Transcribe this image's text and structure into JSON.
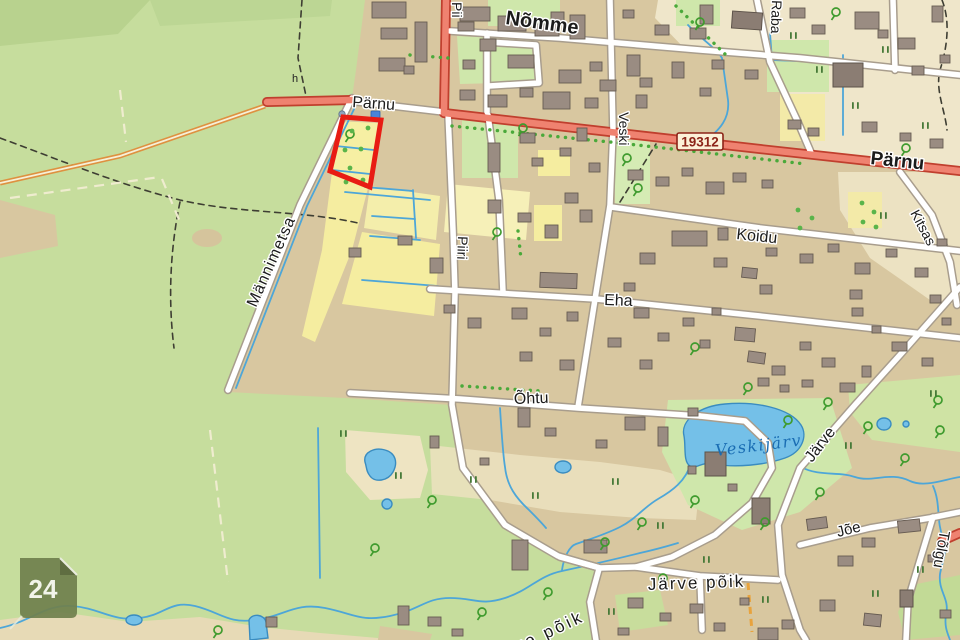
{
  "map": {
    "title": "Topographic map viewer",
    "badges": {
      "road_number": "19312",
      "sheet_number": "24"
    },
    "labels": {
      "nomme": "Nõmme",
      "parnu_west": "Pärnu",
      "parnu_east": "Pärnu",
      "piiri_top": "Pii",
      "piiri": "Piiri",
      "veski": "Veski",
      "raba": "Raba",
      "koidu": "Koidu",
      "eha": "Eha",
      "ohtu": "Õhtu",
      "mannimetsa": "Männimetsa",
      "jarve": "Järve",
      "kitsas": "Kitsas",
      "joe": "Jõe",
      "tolgu": "Tõlgu",
      "jarve_poik": "Järve põik",
      "jarve_poik_south": "Järve põik",
      "veskijarv": "Veskijärv",
      "symbol_h": "h"
    },
    "colors": {
      "forest": "#c6dd9d",
      "urban": "#d8c7a0",
      "field_yellow": "#f5eda0",
      "wetland_cream": "#efe6ca",
      "garden_green": "#cfe7ab",
      "water": "#74c0e8",
      "stream": "#4da6d8",
      "main_road": "#ef8270",
      "main_road_casing": "#c03f2e",
      "road_white": "#ffffff",
      "building": "#9a8c82",
      "parcel_highlight": "#e81c14",
      "sheet_badge": "#70804d",
      "tree_green": "#3f9b2e",
      "water_label": "#1a6db3",
      "road_number_text": "#8c2418"
    },
    "geometry": {
      "buildings": [
        [
          372,
          2,
          34,
          16
        ],
        [
          381,
          28,
          26,
          11
        ],
        [
          415,
          22,
          12,
          40
        ],
        [
          379,
          58,
          26,
          13
        ],
        [
          404,
          66,
          10,
          8
        ],
        [
          460,
          7,
          30,
          14
        ],
        [
          458,
          22,
          16,
          9
        ],
        [
          498,
          16,
          28,
          15
        ],
        [
          535,
          24,
          24,
          12
        ],
        [
          480,
          39,
          16,
          12
        ],
        [
          508,
          55,
          26,
          13
        ],
        [
          463,
          60,
          12,
          9
        ],
        [
          551,
          12,
          13,
          9
        ],
        [
          570,
          15,
          15,
          24
        ],
        [
          559,
          70,
          22,
          13
        ],
        [
          590,
          62,
          12,
          9
        ],
        [
          600,
          80,
          16,
          11
        ],
        [
          627,
          55,
          13,
          21
        ],
        [
          640,
          78,
          12,
          9
        ],
        [
          623,
          10,
          11,
          8
        ],
        [
          655,
          25,
          14,
          10
        ],
        [
          672,
          62,
          12,
          16
        ],
        [
          690,
          28,
          16,
          11
        ],
        [
          700,
          5,
          13,
          19
        ],
        [
          712,
          60,
          12,
          9
        ],
        [
          745,
          70,
          13,
          9
        ],
        [
          700,
          88,
          11,
          8
        ],
        [
          790,
          8,
          15,
          10
        ],
        [
          812,
          25,
          13,
          9
        ],
        [
          855,
          12,
          24,
          17
        ],
        [
          898,
          38,
          17,
          11
        ],
        [
          932,
          6,
          11,
          16
        ],
        [
          912,
          66,
          12,
          9
        ],
        [
          940,
          55,
          10,
          8
        ],
        [
          878,
          30,
          10,
          8
        ],
        [
          460,
          90,
          15,
          10
        ],
        [
          488,
          95,
          19,
          12
        ],
        [
          520,
          88,
          13,
          9
        ],
        [
          543,
          92,
          27,
          17
        ],
        [
          585,
          98,
          13,
          10
        ],
        [
          636,
          95,
          11,
          13
        ],
        [
          628,
          170,
          15,
          10
        ],
        [
          656,
          177,
          13,
          9
        ],
        [
          682,
          168,
          11,
          8
        ],
        [
          706,
          182,
          18,
          12
        ],
        [
          733,
          173,
          13,
          9
        ],
        [
          762,
          180,
          11,
          8
        ],
        [
          788,
          120,
          13,
          9
        ],
        [
          808,
          128,
          11,
          8
        ],
        [
          862,
          122,
          15,
          10
        ],
        [
          900,
          133,
          11,
          8
        ],
        [
          930,
          139,
          13,
          9
        ],
        [
          488,
          143,
          12,
          29
        ],
        [
          520,
          133,
          15,
          10
        ],
        [
          532,
          158,
          11,
          8
        ],
        [
          488,
          200,
          13,
          13
        ],
        [
          518,
          213,
          13,
          9
        ],
        [
          560,
          148,
          11,
          8
        ],
        [
          577,
          128,
          10,
          13
        ],
        [
          589,
          163,
          11,
          9
        ],
        [
          565,
          193,
          13,
          10
        ],
        [
          545,
          225,
          13,
          13
        ],
        [
          580,
          210,
          12,
          12
        ],
        [
          640,
          253,
          15,
          11
        ],
        [
          672,
          231,
          35,
          15
        ],
        [
          714,
          258,
          13,
          9
        ],
        [
          742,
          268,
          15,
          10,
          6
        ],
        [
          766,
          248,
          11,
          8
        ],
        [
          800,
          254,
          13,
          9
        ],
        [
          828,
          244,
          11,
          8
        ],
        [
          855,
          263,
          15,
          11
        ],
        [
          886,
          249,
          11,
          8
        ],
        [
          915,
          268,
          13,
          9
        ],
        [
          937,
          239,
          10,
          7
        ],
        [
          624,
          283,
          11,
          8
        ],
        [
          718,
          228,
          10,
          12
        ],
        [
          760,
          285,
          12,
          9
        ],
        [
          850,
          290,
          12,
          9
        ],
        [
          930,
          295,
          11,
          8
        ],
        [
          349,
          248,
          12,
          9
        ],
        [
          430,
          258,
          13,
          15
        ],
        [
          398,
          236,
          14,
          9
        ],
        [
          540,
          273,
          37,
          15,
          2
        ],
        [
          444,
          305,
          11,
          8
        ],
        [
          468,
          318,
          13,
          10
        ],
        [
          512,
          308,
          15,
          11
        ],
        [
          540,
          328,
          11,
          8
        ],
        [
          567,
          312,
          11,
          9
        ],
        [
          520,
          352,
          12,
          9
        ],
        [
          560,
          360,
          14,
          10
        ],
        [
          608,
          338,
          13,
          9
        ],
        [
          634,
          308,
          15,
          10
        ],
        [
          658,
          333,
          11,
          8
        ],
        [
          683,
          318,
          11,
          8
        ],
        [
          640,
          360,
          12,
          9
        ],
        [
          700,
          340,
          10,
          8
        ],
        [
          712,
          308,
          9,
          7
        ],
        [
          735,
          328,
          20,
          13,
          5
        ],
        [
          748,
          352,
          17,
          11,
          8
        ],
        [
          772,
          366,
          13,
          9
        ],
        [
          800,
          342,
          11,
          8
        ],
        [
          822,
          358,
          13,
          9
        ],
        [
          852,
          308,
          11,
          8
        ],
        [
          872,
          326,
          9,
          7
        ],
        [
          892,
          342,
          15,
          9
        ],
        [
          922,
          358,
          11,
          8
        ],
        [
          942,
          318,
          9,
          7
        ],
        [
          758,
          378,
          11,
          8
        ],
        [
          780,
          385,
          9,
          7
        ],
        [
          802,
          380,
          11,
          7
        ],
        [
          840,
          383,
          15,
          9
        ],
        [
          862,
          366,
          9,
          11
        ],
        [
          518,
          408,
          12,
          19
        ],
        [
          545,
          428,
          11,
          8
        ],
        [
          625,
          417,
          20,
          13
        ],
        [
          658,
          427,
          10,
          19
        ],
        [
          688,
          408,
          10,
          8
        ],
        [
          480,
          458,
          9,
          7
        ],
        [
          430,
          436,
          9,
          12
        ],
        [
          596,
          440,
          11,
          8
        ],
        [
          688,
          466,
          8,
          8
        ],
        [
          728,
          484,
          9,
          7
        ],
        [
          807,
          518,
          20,
          11,
          -8
        ],
        [
          898,
          520,
          22,
          12,
          -6
        ],
        [
          862,
          538,
          13,
          9
        ],
        [
          838,
          556,
          15,
          10
        ],
        [
          864,
          614,
          17,
          12,
          6
        ],
        [
          820,
          600,
          15,
          11
        ],
        [
          928,
          555,
          9,
          7
        ],
        [
          940,
          610,
          11,
          8
        ],
        [
          782,
          620,
          12,
          9
        ],
        [
          758,
          628,
          20,
          12
        ],
        [
          628,
          598,
          15,
          10
        ],
        [
          660,
          613,
          11,
          8
        ],
        [
          690,
          604,
          13,
          9
        ],
        [
          714,
          623,
          11,
          8
        ],
        [
          740,
          598,
          9,
          7
        ],
        [
          618,
          628,
          11,
          7
        ],
        [
          584,
          540,
          23,
          13
        ],
        [
          512,
          540,
          16,
          30
        ],
        [
          398,
          606,
          11,
          19
        ],
        [
          428,
          617,
          13,
          9
        ],
        [
          452,
          629,
          11,
          7
        ],
        [
          266,
          617,
          11,
          10
        ]
      ],
      "buildings_dark": [
        [
          732,
          12,
          30,
          17,
          4
        ],
        [
          833,
          63,
          30,
          24
        ],
        [
          705,
          452,
          21,
          24
        ],
        [
          752,
          498,
          18,
          26
        ],
        [
          900,
          590,
          13,
          17
        ]
      ],
      "trees": [
        [
          350,
          134
        ],
        [
          523,
          128
        ],
        [
          497,
          232
        ],
        [
          627,
          158
        ],
        [
          638,
          188
        ],
        [
          695,
          347
        ],
        [
          748,
          387
        ],
        [
          788,
          420
        ],
        [
          828,
          402
        ],
        [
          868,
          426
        ],
        [
          905,
          458
        ],
        [
          938,
          400
        ],
        [
          820,
          492
        ],
        [
          765,
          522
        ],
        [
          695,
          500
        ],
        [
          642,
          522
        ],
        [
          605,
          542
        ],
        [
          663,
          578
        ],
        [
          700,
          22
        ],
        [
          836,
          12
        ],
        [
          906,
          148
        ],
        [
          432,
          500
        ],
        [
          482,
          612
        ],
        [
          548,
          592
        ],
        [
          375,
          548
        ],
        [
          940,
          430
        ],
        [
          218,
          630
        ]
      ],
      "grass": [
        [
          470,
          476
        ],
        [
          532,
          492
        ],
        [
          612,
          478
        ],
        [
          657,
          522
        ],
        [
          703,
          556
        ],
        [
          762,
          596
        ],
        [
          872,
          590
        ],
        [
          917,
          566
        ],
        [
          845,
          442
        ],
        [
          395,
          472
        ],
        [
          790,
          32
        ],
        [
          816,
          66
        ],
        [
          852,
          102
        ],
        [
          882,
          46
        ],
        [
          922,
          122
        ],
        [
          880,
          212
        ],
        [
          340,
          430
        ],
        [
          608,
          608
        ],
        [
          930,
          390
        ]
      ],
      "orchard_dots": [
        [
          352,
          131
        ],
        [
          368,
          128
        ],
        [
          345,
          150
        ],
        [
          361,
          149
        ],
        [
          350,
          168
        ],
        [
          346,
          182
        ],
        [
          363,
          180
        ],
        [
          862,
          203
        ],
        [
          874,
          212
        ],
        [
          863,
          222
        ],
        [
          876,
          227
        ],
        [
          798,
          210
        ],
        [
          812,
          218
        ],
        [
          800,
          228
        ]
      ],
      "streams": [
        "M0,628 C30,622 45,604 72,606 C100,608 112,622 140,618 C165,615 170,600 195,606 C220,612 228,624 255,620 C285,616 295,602 325,608 C355,614 360,622 390,616 C420,610 425,598 450,598 C475,598 480,606 505,598 C530,590 538,576 562,571 C590,565 612,560 640,553 C658,549 668,546 678,543",
        "M691,463 C686,481 672,491 658,499 C644,507 636,519 620,527 C604,535 590,539 576,544 C570,546 564,556 562,570",
        "M801,467 C820,477 838,471 855,477 C872,483 890,471 910,481 C925,488 945,479 960,477",
        "M933,486 C941,504 936,520 943,538 C948,552 942,562 940,574 C938,592 950,598 946,615 C944,627 948,634 950,640",
        "M500,408 C502,440 503,455 505,467 C507,486 516,498 529,510 C536,517 541,522 546,528",
        "M318,428 L320,578",
        "M357,103 L307,206 L236,388",
        "M336,146 L374,150",
        "M332,170 L370,174",
        "M345,192 L430,200",
        "M365,187 L413,191",
        "M413,190 L416,238",
        "M372,216 L415,219",
        "M370,236 L420,240",
        "M362,280 L438,286",
        "M688,25 C700,38 716,48 722,58 L728,100 C730,118 720,130 706,140",
        "M770,33 L772,60 L820,62",
        "M843,55 L843,135"
      ],
      "trails": [
        "M0,138 C60,160 120,185 180,200 C240,214 300,210 358,223",
        "M302,0 L298,58 L306,96",
        "M620,202 L656,144",
        "M942,0 C950,20 948,45 940,70 C935,90 945,110 947,130",
        "M180,202 C170,250 168,300 174,348"
      ],
      "light_boundaries": [
        "M10,198 L160,177",
        "M120,90 L126,142",
        "M162,179 L180,222",
        "M210,430 L228,582"
      ],
      "tree_rows": [
        "M452,126 L610,142 L806,164",
        "M410,55 L448,58",
        "M462,386 L540,391",
        "M676,6 L728,57",
        "M518,231 L521,259"
      ]
    }
  }
}
